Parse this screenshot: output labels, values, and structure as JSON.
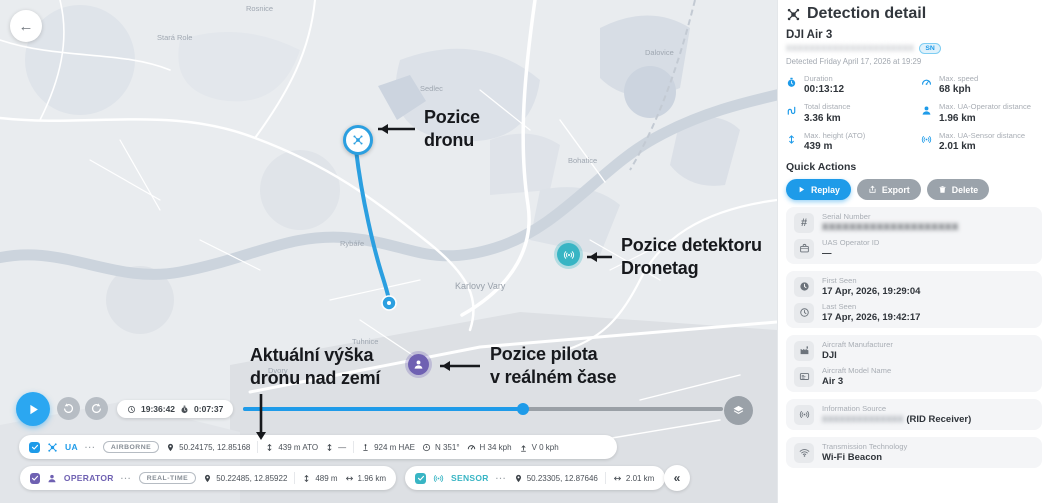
{
  "colors": {
    "primary_blue": "#1e9be9",
    "operator_purple": "#6f61b2",
    "sensor_teal": "#38b5c4",
    "annotation_black": "#17191d"
  },
  "map": {
    "labels": [
      {
        "text": "Rosnice"
      },
      {
        "text": "Stará Role"
      },
      {
        "text": "Dalovice"
      },
      {
        "text": "Sedlec"
      },
      {
        "text": "Rybáře"
      },
      {
        "text": "Bohatice"
      },
      {
        "text": "Karlovy Vary"
      },
      {
        "text": "Tuhnice"
      },
      {
        "text": "Dvory"
      }
    ],
    "annotations": {
      "drone_line1": "Pozice",
      "drone_line2": "dronu",
      "detector_line1": "Pozice detektoru",
      "detector_line2": "Dronetag",
      "pilot_line1": "Pozice pilota",
      "pilot_line2": "v reálném čase",
      "height_line1": "Aktuální výška",
      "height_line2": "dronu nad zemí"
    }
  },
  "playback": {
    "time": "19:36:42",
    "elapsed": "0:07:37",
    "progress_pct": 58
  },
  "bars": {
    "more": "···",
    "collapse": "«",
    "ua": {
      "name": "UA",
      "status": "AIRBORNE",
      "coords": "50.24175, 12.85168",
      "ato": "439 m ATO",
      "dash": "—",
      "hae": "924 m HAE",
      "heading": "N 351°",
      "hspeed": "H 34 kph",
      "vspeed": "V 0 kph"
    },
    "operator": {
      "name": "OPERATOR",
      "status": "REAL-TIME",
      "coords": "50.22485, 12.85922",
      "height": "489 m",
      "distance": "1.96 km"
    },
    "sensor": {
      "name": "SENSOR",
      "coords": "50.23305, 12.87646",
      "distance": "2.01 km"
    }
  },
  "detail": {
    "title": "Detection detail",
    "aircraft_name": "DJI Air 3",
    "serial_redacted": "XXXXXXXXXXXXXXXXXXXXXX",
    "sn_badge": "SN",
    "detected_line": "Detected Friday April 17, 2026 at 19:29",
    "stats": [
      {
        "icon": "stopwatch-icon",
        "label": "Duration",
        "value": "00:13:12"
      },
      {
        "icon": "speedometer-icon",
        "label": "Max. speed",
        "value": "68 kph"
      },
      {
        "icon": "route-icon",
        "label": "Total distance",
        "value": "3.36 km"
      },
      {
        "icon": "person-icon",
        "label": "Max. UA-Operator distance",
        "value": "1.96 km"
      },
      {
        "icon": "height-icon",
        "label": "Max. height (ATO)",
        "value": "439 m"
      },
      {
        "icon": "signal-icon",
        "label": "Max. UA-Sensor distance",
        "value": "2.01 km"
      }
    ],
    "quick_actions": {
      "heading": "Quick Actions",
      "replay": "Replay",
      "export": "Export",
      "delete": "Delete"
    },
    "cards": {
      "serial": {
        "icon": "hash-icon",
        "label": "Serial Number",
        "value_redacted": "XXXXXXXXXXXXXXXXXXXX"
      },
      "uas_operator_id": {
        "icon": "briefcase-icon",
        "label": "UAS Operator ID",
        "value": "—"
      },
      "first_seen": {
        "icon": "clock-filled-icon",
        "label": "First Seen",
        "value": "17 Apr, 2026, 19:29:04"
      },
      "last_seen": {
        "icon": "clock-icon",
        "label": "Last Seen",
        "value": "17 Apr, 2026, 19:42:17"
      },
      "manufacturer": {
        "icon": "factory-icon",
        "label": "Aircraft Manufacturer",
        "value": "DJI"
      },
      "model": {
        "icon": "card-icon",
        "label": "Aircraft Model Name",
        "value": "Air 3"
      },
      "info_source": {
        "icon": "signal-icon",
        "label": "Information Source",
        "value_redacted": "XXXXXXXXXXXXXX",
        "value_suffix": "(RID Receiver)"
      },
      "transmission": {
        "icon": "wifi-icon",
        "label": "Transmission Technology",
        "value": "Wi-Fi Beacon"
      }
    }
  }
}
